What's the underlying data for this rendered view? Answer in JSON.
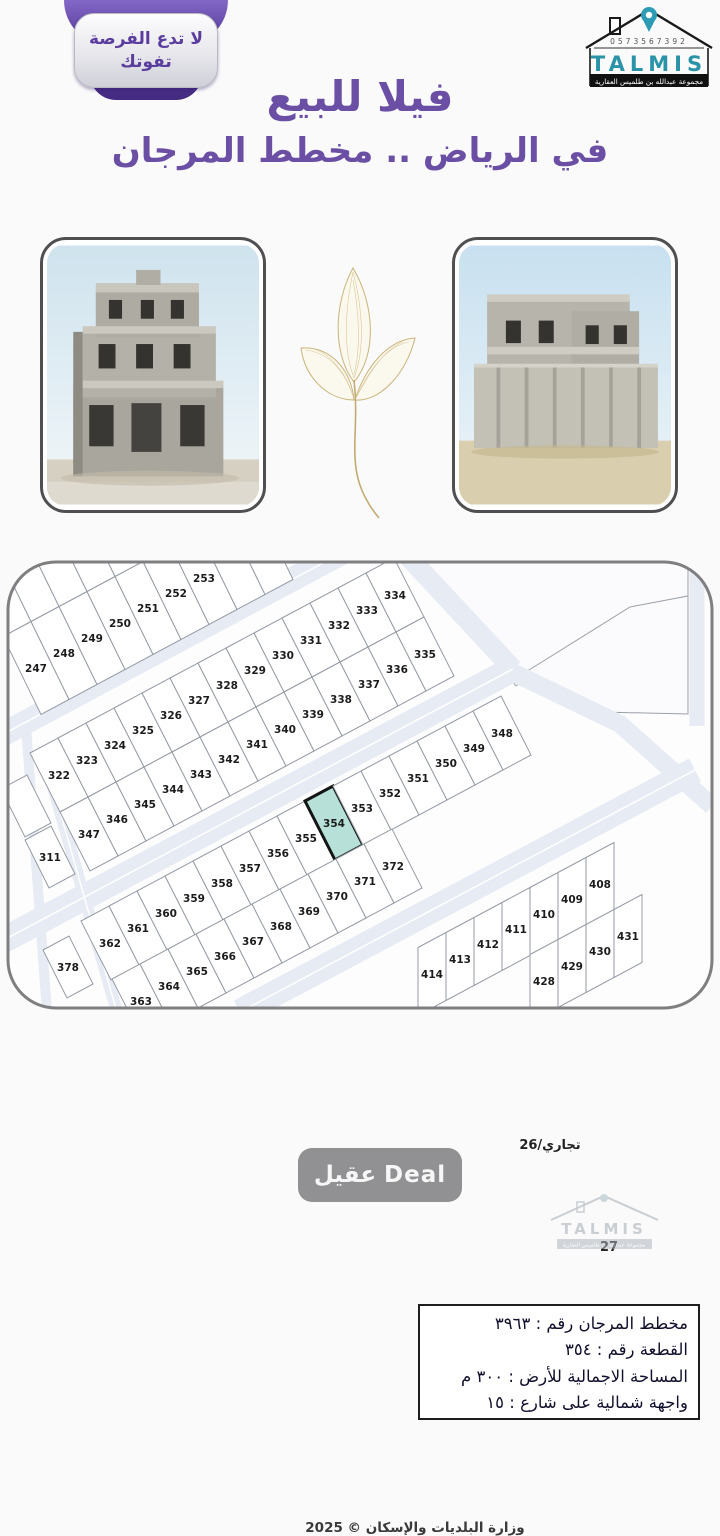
{
  "badge": {
    "line1": "لا تدع الفرصة",
    "line2": "تفوتك"
  },
  "logo": {
    "phone": "0573567392",
    "brand": "TALMIS",
    "tagline": "مجموعة عبدالله بن طلميس العقارية"
  },
  "title": {
    "line1": "فيلا للبيع",
    "line2": "في الرياض .. مخطط المرجان"
  },
  "colors": {
    "purple": "#6a4fa5",
    "teal": "#2a93a8",
    "highlight": "#b7e0d8",
    "street": "#e7ebf3"
  },
  "map": {
    "commercial_label": "تجاري/26",
    "parcel27_label": "27",
    "deal_watermark": "عقيل Deal",
    "talmis_watermark": "TALMIS",
    "talmis_watermark_tagline": "مجموعة عبدالله بن طلميس العقارية",
    "ministry_credit": "وزارة البلديات والإسكان © 2025",
    "highlight": {
      "number": "354",
      "fill": "#b7e0d8"
    },
    "info_box": {
      "lines": [
        "مخطط المرجان رقم : ٣٩٦٣",
        "القطعة رقم : ٣٥٤",
        "المساحة الاجمالية للأرض : ٣٠٠ م",
        "واجهة شمالية على شارع : ١٥"
      ]
    },
    "rows": [
      {
        "c": [
          36,
          668
        ],
        "u": [
          28,
          -15
        ],
        "v": [
          38,
          78
        ],
        "nums": [
          "247",
          "248",
          "249",
          "250",
          "251",
          "252",
          "253",
          "",
          ""
        ]
      },
      {
        "c": [
          -2,
          590
        ],
        "u": [
          28,
          -15
        ],
        "v": [
          38,
          78
        ],
        "nums": [
          "",
          "",
          "",
          "",
          "",
          "",
          "",
          "",
          ""
        ]
      },
      {
        "c": [
          59,
          775
        ],
        "u": [
          28,
          -15
        ],
        "v": [
          30,
          59
        ],
        "nums": [
          "322",
          "323",
          "324",
          "325",
          "326",
          "327",
          "328",
          "329",
          "330",
          "331",
          "332",
          "333",
          "334"
        ]
      },
      {
        "c": [
          89,
          834
        ],
        "u": [
          28,
          -15
        ],
        "v": [
          30,
          59
        ],
        "nums": [
          "347",
          "346",
          "345",
          "344",
          "343",
          "342",
          "341",
          "340",
          "339",
          "338",
          "337",
          "336",
          "335"
        ]
      },
      {
        "c": [
          110,
          943
        ],
        "u": [
          28,
          -15
        ],
        "v": [
          30,
          59
        ],
        "nums": [
          "362",
          "361",
          "360",
          "359",
          "358",
          "357",
          "356",
          "355",
          "354",
          "353",
          "352",
          "351",
          "350",
          "349",
          "348"
        ]
      },
      {
        "c": [
          141,
          1001
        ],
        "u": [
          28,
          -15
        ],
        "v": [
          30,
          59
        ],
        "nums": [
          "363",
          "364",
          "365",
          "366",
          "367",
          "368",
          "369",
          "370",
          "371",
          "372"
        ]
      },
      {
        "c": [
          432,
          974
        ],
        "u": [
          28,
          -15
        ],
        "v": [
          0,
          68
        ],
        "nums": [
          "414",
          "413",
          "412",
          "411",
          "410",
          "409",
          "408"
        ]
      },
      {
        "c": [
          544,
          981
        ],
        "u": [
          28,
          -15
        ],
        "v": [
          0,
          68
        ],
        "nums": [
          "428",
          "429",
          "430",
          "431"
        ]
      },
      {
        "c": [
          50,
          857
        ],
        "u": [
          26,
          -14
        ],
        "v": [
          24,
          48
        ],
        "nums": [
          "311"
        ]
      },
      {
        "c": [
          68,
          967
        ],
        "u": [
          26,
          -14
        ],
        "v": [
          24,
          48
        ],
        "nums": [
          "378"
        ]
      },
      {
        "c": [
          26,
          806
        ],
        "u": [
          26,
          -14
        ],
        "v": [
          24,
          48
        ],
        "nums": [
          ""
        ]
      }
    ]
  }
}
